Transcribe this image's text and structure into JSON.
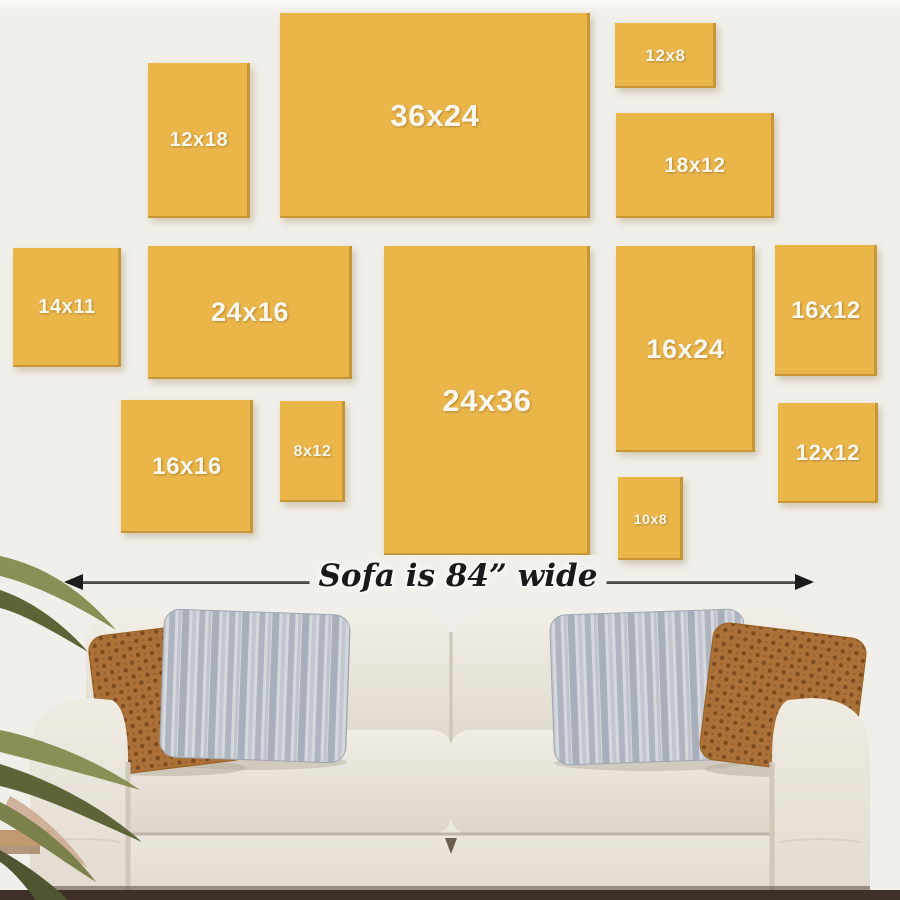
{
  "guide": {
    "frames": [
      {
        "label": "12x18",
        "x": 148,
        "y": 63,
        "w": 102,
        "h": 155,
        "font": 20
      },
      {
        "label": "36x24",
        "x": 280,
        "y": 13,
        "w": 310,
        "h": 205,
        "font": 31
      },
      {
        "label": "12x8",
        "x": 615,
        "y": 23,
        "w": 101,
        "h": 65,
        "font": 17
      },
      {
        "label": "18x12",
        "x": 616,
        "y": 113,
        "w": 158,
        "h": 105,
        "font": 21
      },
      {
        "label": "14x11",
        "x": 13,
        "y": 248,
        "w": 108,
        "h": 119,
        "font": 20
      },
      {
        "label": "24x16",
        "x": 148,
        "y": 246,
        "w": 204,
        "h": 133,
        "font": 27
      },
      {
        "label": "24x36",
        "x": 384,
        "y": 246,
        "w": 206,
        "h": 309,
        "font": 31
      },
      {
        "label": "16x24",
        "x": 616,
        "y": 246,
        "w": 139,
        "h": 206,
        "font": 27
      },
      {
        "label": "16x12",
        "x": 775,
        "y": 245,
        "w": 102,
        "h": 131,
        "font": 24
      },
      {
        "label": "16x16",
        "x": 121,
        "y": 400,
        "w": 132,
        "h": 133,
        "font": 24
      },
      {
        "label": "8x12",
        "x": 280,
        "y": 401,
        "w": 65,
        "h": 101,
        "font": 16
      },
      {
        "label": "10x8",
        "x": 618,
        "y": 477,
        "w": 65,
        "h": 83,
        "font": 14
      },
      {
        "label": "12x12",
        "x": 778,
        "y": 403,
        "w": 100,
        "h": 100,
        "font": 22
      }
    ],
    "measure": {
      "label": "Sofa is 84” wide"
    }
  },
  "colors": {
    "frame-fill": "#EAB64A",
    "frame-label": "#FCF8EF",
    "wall": "#F1EFE9",
    "wall-top": "#FBFAF7",
    "arrow-line": "#3C3C3C",
    "arrow-head": "#1C1C1C",
    "measure-text": "#1A1A1A",
    "floor-dark": "#3E3029",
    "floor-light": "#C19A70",
    "sofa-body": "#E9E4DA",
    "sofa-shadow": "#CFC8BB",
    "pillow-rust": "#AC7138",
    "pillow-rust-dark": "#7C4B20",
    "pillow-gray": "#CDD1D7",
    "pillow-gray-dark": "#A2AAB6",
    "plant-green": "#7C814B",
    "plant-green-dark": "#555A31"
  }
}
